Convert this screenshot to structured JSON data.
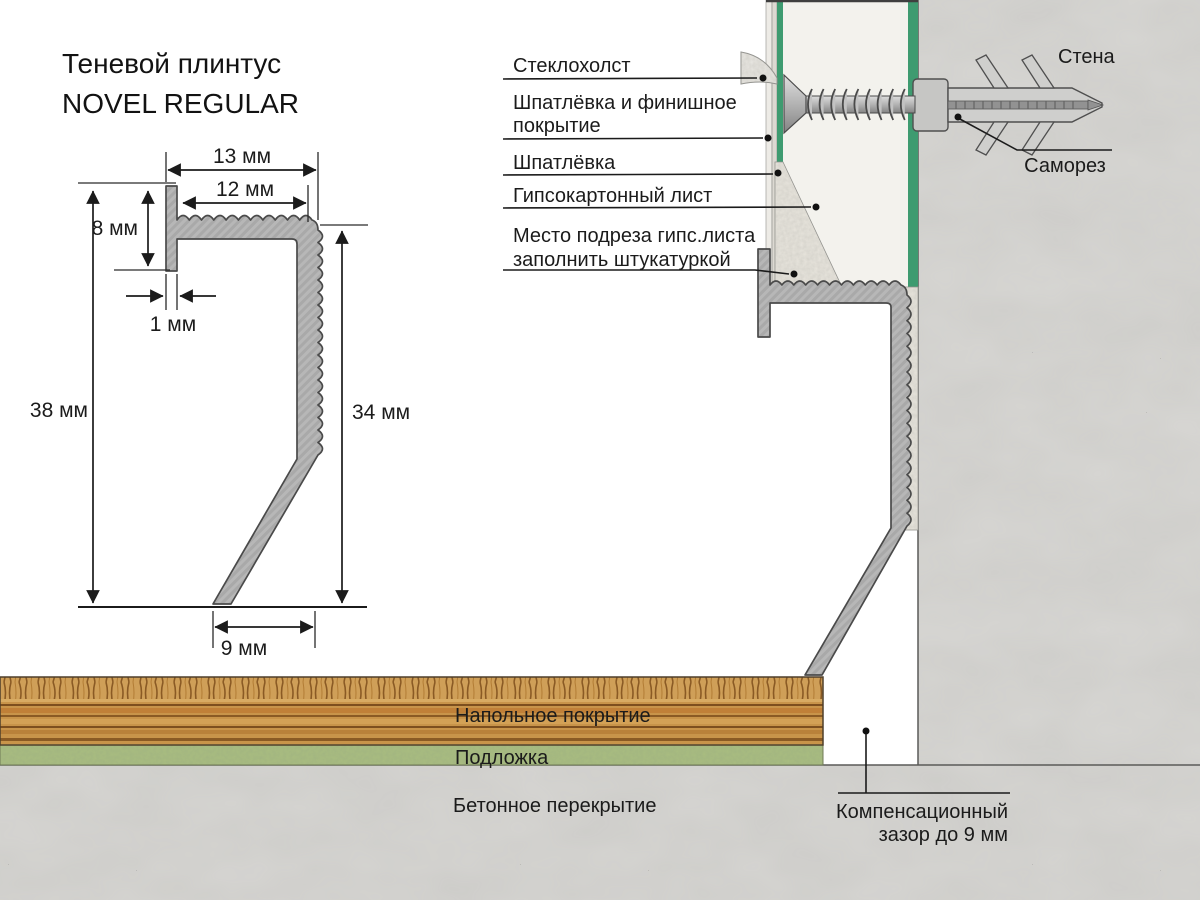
{
  "title": {
    "line1": "Теневой плинтус",
    "line2": "NOVEL REGULAR"
  },
  "dims": {
    "d13": "13 мм",
    "d12": "12 мм",
    "d8": "8 мм",
    "d1": "1 мм",
    "d38": "38 мм",
    "d34": "34 мм",
    "d9": "9 мм"
  },
  "callouts": {
    "fiberglass": "Стеклохолст",
    "putty_finish_1": "Шпатлёвка и финишное",
    "putty_finish_2": "покрытие",
    "putty": "Шпатлёвка",
    "drywall": "Гипсокартонный лист",
    "cut_note_1": "Место подреза гипс.листа",
    "cut_note_2": "заполнить штукатуркой",
    "wall": "Стена",
    "screw": "Саморез",
    "floor_covering": "Напольное покрытие",
    "underlay": "Подложка",
    "slab": "Бетонное перекрытие",
    "gap_1": "Компенсационный",
    "gap_2": "зазор  до 9 мм"
  },
  "colors": {
    "drywall_face_green": "#3e9b70",
    "underlay_green": "#a9bd80",
    "concrete": "#d6d5d2",
    "drywall_core": "#f3f2ed",
    "plaster_fill": "#e8e5dd",
    "putty_layer": "#dcd9d2",
    "finish_layer": "#edebe6",
    "profile_gray": "#b6b6b6",
    "wood_base": "#c8944a"
  }
}
